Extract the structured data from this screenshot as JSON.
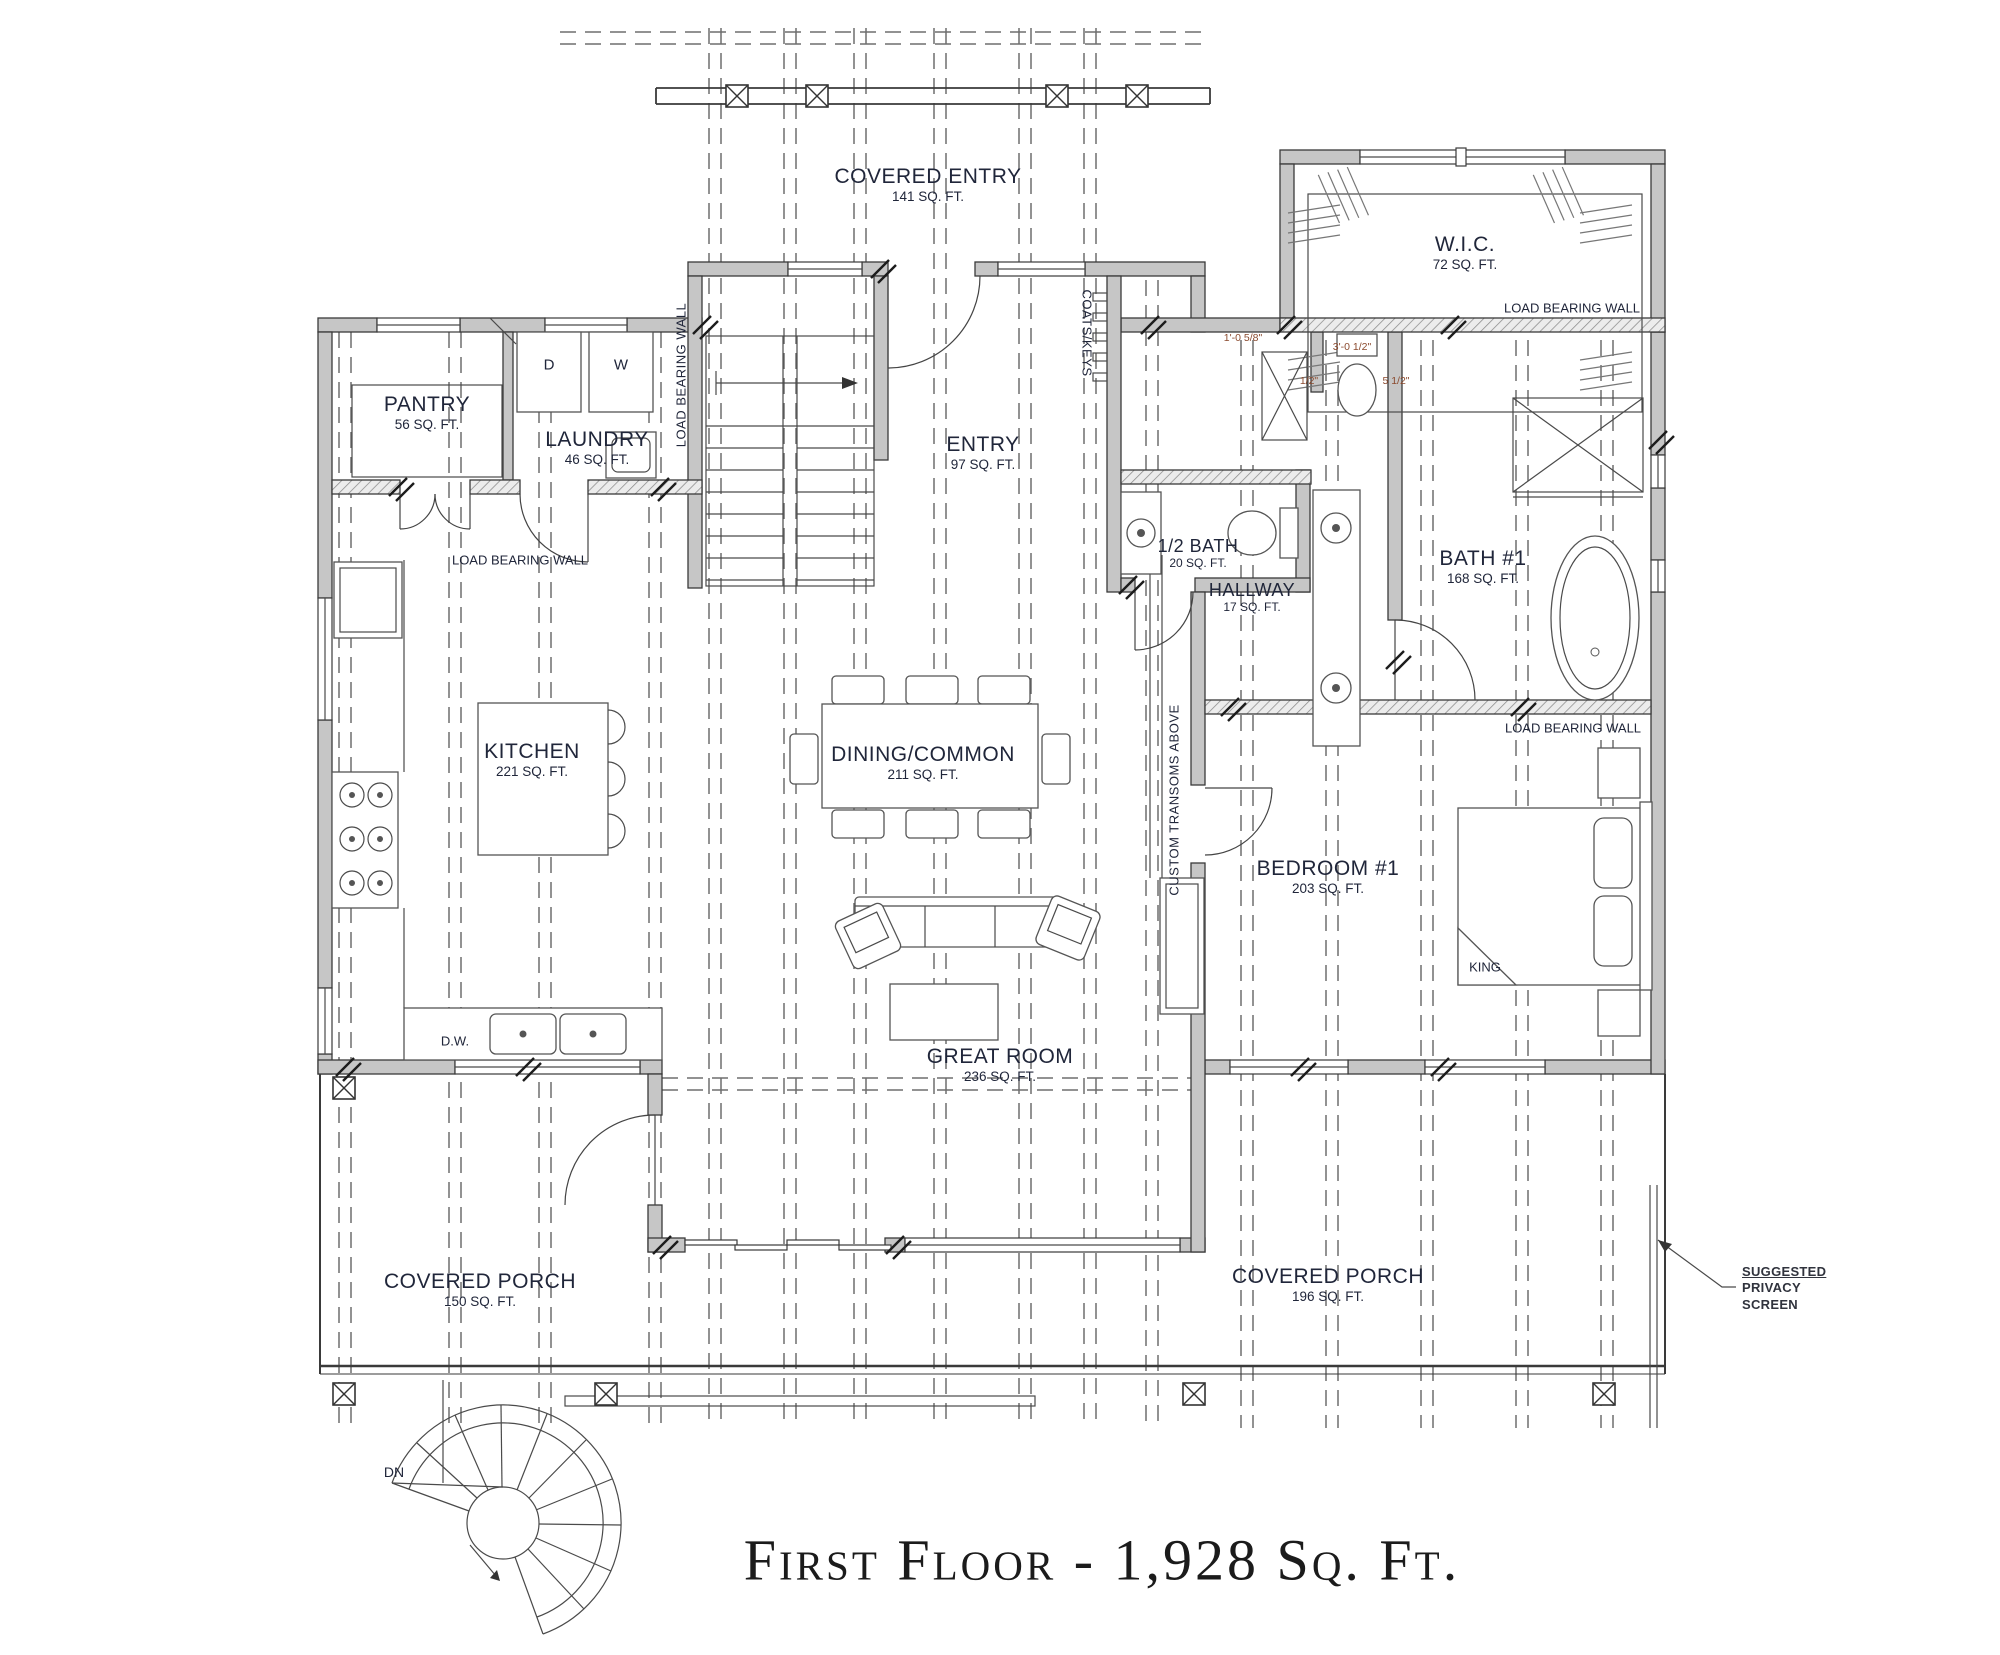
{
  "title": {
    "text": "First Floor - 1,928 Sq. Ft."
  },
  "rooms": {
    "covered_entry": {
      "name": "COVERED ENTRY",
      "area": "141 SQ. FT."
    },
    "wic": {
      "name": "W.I.C.",
      "area": "72 SQ. FT."
    },
    "pantry": {
      "name": "PANTRY",
      "area": "56 SQ. FT."
    },
    "laundry": {
      "name": "LAUNDRY",
      "area": "46 SQ. FT."
    },
    "entry": {
      "name": "ENTRY",
      "area": "97 SQ. FT."
    },
    "half_bath": {
      "name": "1/2 BATH",
      "area": "20 SQ. FT."
    },
    "hallway": {
      "name": "HALLWAY",
      "area": "17 SQ. FT."
    },
    "bath1": {
      "name": "BATH #1",
      "area": "168 SQ. FT."
    },
    "kitchen": {
      "name": "KITCHEN",
      "area": "221 SQ. FT."
    },
    "dining": {
      "name": "DINING/COMMON",
      "area": "211 SQ. FT."
    },
    "great_room": {
      "name": "GREAT ROOM",
      "area": "236 SQ. FT."
    },
    "bedroom1": {
      "name": "BEDROOM #1",
      "area": "203 SQ. FT."
    },
    "porch_left": {
      "name": "COVERED PORCH",
      "area": "150 SQ. FT."
    },
    "porch_right": {
      "name": "COVERED PORCH",
      "area": "196 SQ. FT."
    }
  },
  "annotations": {
    "load_bearing_wall": "LOAD BEARING WALL",
    "coats_keys": "COATS/KEYS",
    "custom_transoms": "CUSTOM TRANSOMS ABOVE",
    "king": "KING",
    "dw": "D.W.",
    "dn": "DN",
    "dryer": "D",
    "washer": "W",
    "privacy": {
      "line1": "SUGGESTED",
      "line2": "PRIVACY",
      "line3": "SCREEN"
    }
  },
  "dimensions": {
    "d1": "1'-0 5/8\"",
    "d2": "3'-0 1/2\"",
    "d3": "5 1/2\"",
    "d4": "1/2\""
  },
  "colors": {
    "label_text": "#20263a",
    "dimension_text": "#8b4a2e",
    "wall_fill": "#c6c6c6",
    "line": "#3a3a3a"
  }
}
